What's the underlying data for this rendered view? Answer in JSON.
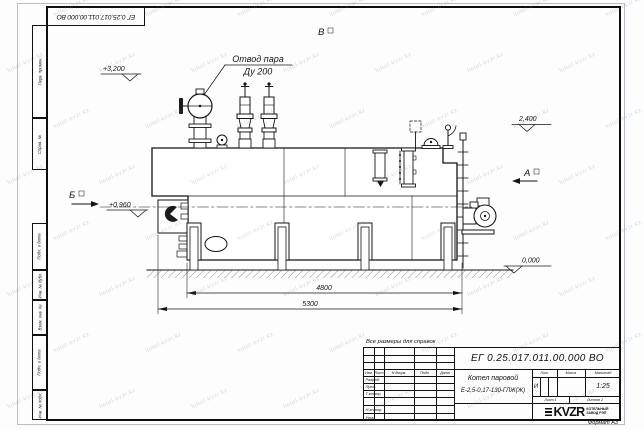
{
  "watermark": {
    "text": "kotel-kvzr.kz"
  },
  "frame": {
    "stamp_rotated": "ЕГ 0.25.017.011.00.000  ВО",
    "format_note": "Формат А3"
  },
  "margin": {
    "labels": [
      "Перв. примен.",
      "Справ. №",
      "Подп. и дата",
      "Инв. № дубл.",
      "Взам. инв. №",
      "Подп. и дата",
      "Инв. № подл."
    ]
  },
  "drawing": {
    "note": "Все размеры для справок",
    "callout_line1": "Отвод пара",
    "callout_line2": "Ду 200",
    "view_b": "Б",
    "view_a": "А",
    "view_v": "В",
    "elev_top": "+3,200",
    "elev_right": "2,400",
    "elev_left": "+0,960",
    "elev_zero": "0,000",
    "dim_4800": "4800",
    "dim_5300": "5300"
  },
  "title_block": {
    "designation": "ЕГ 0.25.017.011.00.000  ВО",
    "product_name": "Котел паровой",
    "product_type": "Е-2,5-0,17-130-ГЛЖ(Ж)",
    "col_izm": "Изм.",
    "col_list": "Лист",
    "col_doc": "N докум.",
    "col_podp": "Подп.",
    "col_data": "Дата",
    "row_razrab": "Разраб.",
    "row_prov": "Пров.",
    "row_tkontr": "Т.контр.",
    "row_nkontr": "Н.контр.",
    "row_utv": "Утв.",
    "lit_label": "Лит.",
    "lit_value": "И",
    "mass_label": "Масса",
    "scale_label": "Масштаб",
    "scale_value": "1:25",
    "sheet": "Лист 1",
    "sheets": "Листов 2",
    "logo": "KVZR",
    "company_line1": "КОТЕЛЬНЫЙ",
    "company_line2": "ЗАВОД РЭП"
  }
}
